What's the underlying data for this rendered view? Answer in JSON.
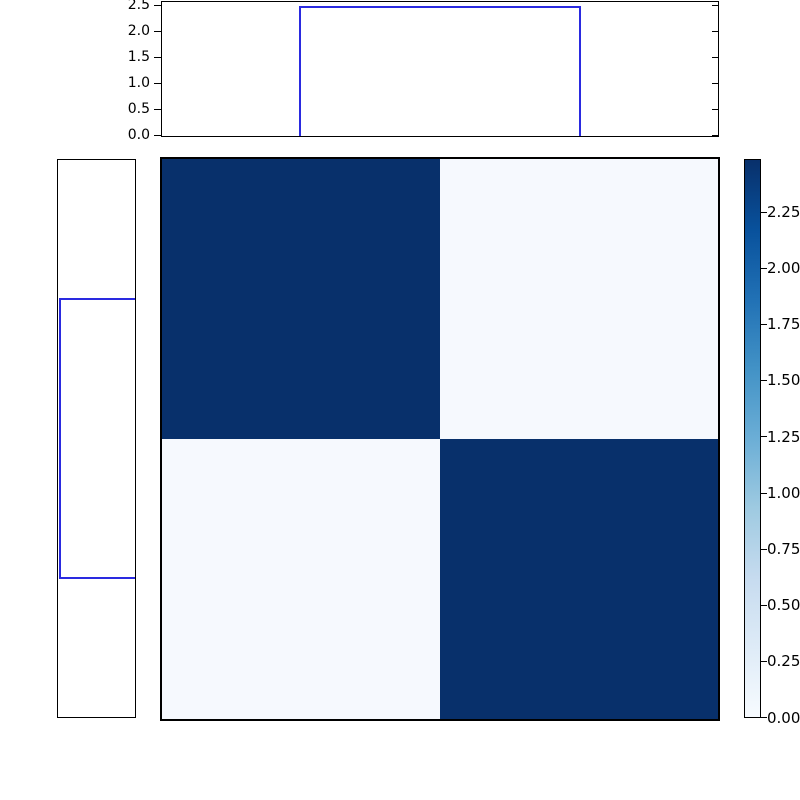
{
  "figure": {
    "background": "#ffffff",
    "spine_color": "#000000",
    "step_color": "#2a2ae0"
  },
  "top_hist": {
    "tick_labels": [
      "2.5",
      "2.0",
      "1.5",
      "1.0",
      "0.5",
      "0.0"
    ]
  },
  "left_hist": {
    "tick_labels": []
  },
  "heatmap": {
    "colormap": "Blues",
    "colors": {
      "tl": "#08306b",
      "tr": "#f6f9fe",
      "bl": "#f6f9fe",
      "br": "#08306b"
    }
  },
  "colorbar": {
    "colormap": "Blues",
    "min_color": "#f7fbff",
    "max_color": "#08306b",
    "tick_labels": [
      "2.25",
      "2.00",
      "1.75",
      "1.50",
      "1.25",
      "1.00",
      "0.75",
      "0.50",
      "0.25",
      "0.00"
    ]
  },
  "chart_data": [
    {
      "type": "heatmap",
      "title": "",
      "matrix": [
        [
          2.47,
          0.03
        ],
        [
          0.03,
          2.47
        ]
      ],
      "rows": 2,
      "cols": 2,
      "colormap": "Blues",
      "vmin": 0.0,
      "vmax": 2.48,
      "colorbar_ticks": [
        0.0,
        0.25,
        0.5,
        0.75,
        1.0,
        1.25,
        1.5,
        1.75,
        2.0,
        2.25
      ],
      "legend_position": "right-colorbar",
      "grid": false,
      "axis_tick_labels": "none"
    },
    {
      "type": "bar",
      "title": "top marginal step histogram",
      "orientation": "vertical",
      "bins_x_fraction_of_axis": [
        [
          0.25,
          0.75
        ]
      ],
      "values": [
        2.47
      ],
      "baseline": 0.0,
      "ylim": [
        0,
        2.6
      ],
      "yticks": [
        0.0,
        0.5,
        1.0,
        1.5,
        2.0,
        2.5
      ],
      "style": "step-outline",
      "line_color": "#2a2ae0"
    },
    {
      "type": "bar",
      "title": "left marginal step histogram",
      "orientation": "horizontal",
      "value_axis_inverted": true,
      "bins_y_fraction_of_axis": [
        [
          0.25,
          0.75
        ]
      ],
      "values": [
        2.47
      ],
      "baseline": 0.0,
      "xlim": [
        0,
        2.6
      ],
      "style": "step-outline",
      "line_color": "#2a2ae0"
    }
  ]
}
